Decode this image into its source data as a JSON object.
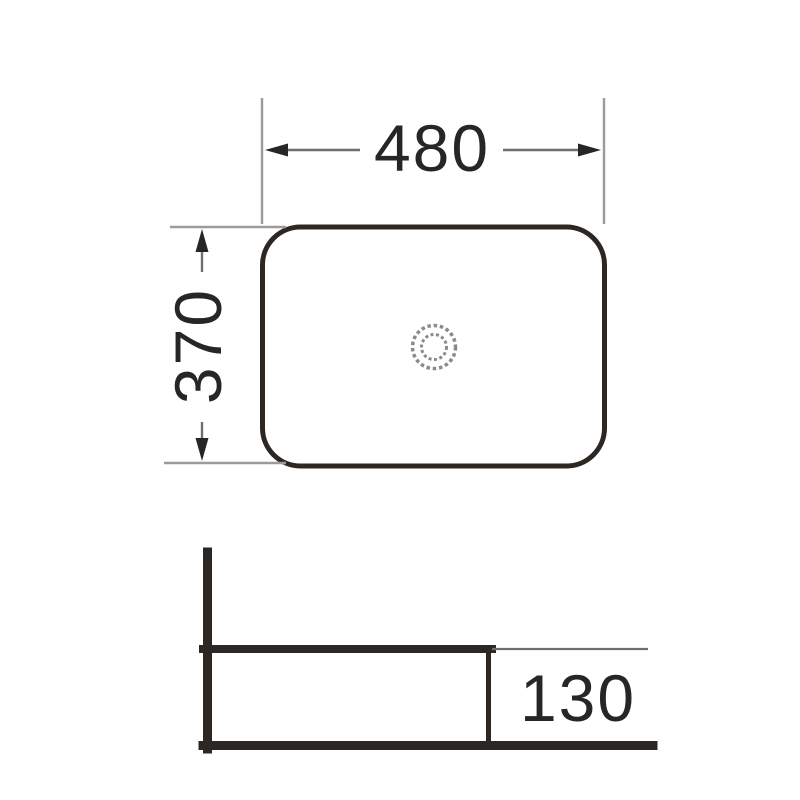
{
  "drawing": {
    "views": {
      "top_view": {
        "width_label": "480",
        "depth_label": "370"
      },
      "side_view": {
        "height_label": "130"
      }
    },
    "colors": {
      "outline": "#2d2723",
      "extension_line": "#9b9b9b",
      "dimension_line": "#6f6f6f",
      "arrow": "#262626",
      "text": "#262626",
      "drain": "#8a8a8a"
    }
  }
}
